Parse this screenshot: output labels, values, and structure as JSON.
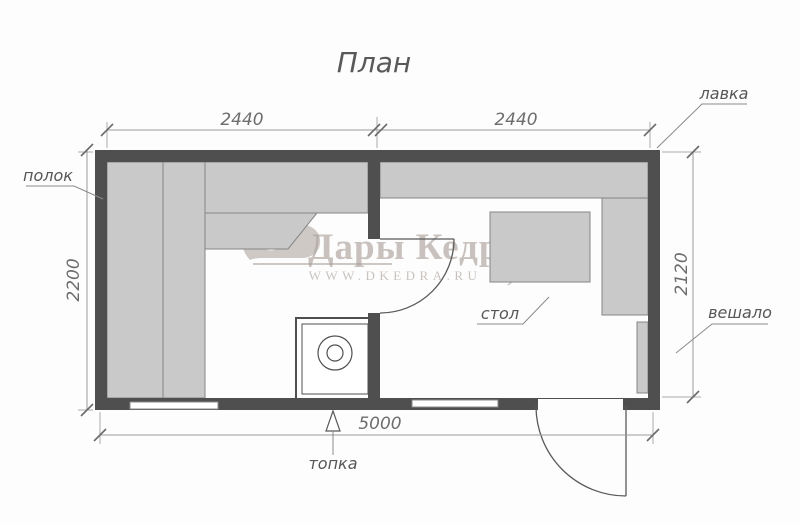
{
  "title": "План",
  "plan": {
    "dimensions": {
      "room_left_width": "2440",
      "room_right_width": "2440",
      "height_left": "2200",
      "height_right": "2120",
      "total_width": "5000"
    },
    "labels": {
      "polok": "полок",
      "lavka": "лавка",
      "veshalo": "вешало",
      "stol": "стол",
      "topka": "топка"
    }
  },
  "watermark": {
    "brand": "Дары Кедра",
    "url": "WWW.DKEDRA.RU"
  },
  "colors": {
    "wall": "#4f4f4f",
    "bench_fill": "#c9c9c9",
    "bench_stroke": "#858585",
    "dim_line": "#9a9a9a",
    "annotation_text": "#575757",
    "watermark": "#a89e97"
  }
}
